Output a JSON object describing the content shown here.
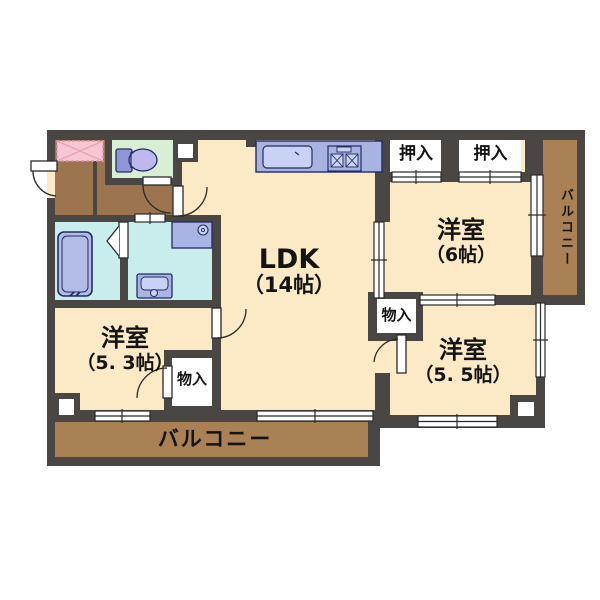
{
  "rooms": {
    "ldk": {
      "name": "LDK",
      "size": "（14帖）"
    },
    "bedroom_ne": {
      "name": "洋室",
      "size": "（6帖）"
    },
    "bedroom_se": {
      "name": "洋室",
      "size": "（5. 5帖）"
    },
    "bedroom_sw": {
      "name": "洋室",
      "size": "（5. 3帖）"
    }
  },
  "closets": {
    "oshiire_left": "押入",
    "oshiire_right": "押入",
    "monoiri_sw": "物入",
    "monoiri_se": "物入"
  },
  "balconies": {
    "south": "バルコニー",
    "east": "バルコニー"
  },
  "fixtures": {
    "bathtub": "bathtub-icon",
    "toilet": "toilet-icon",
    "washbasin": "washbasin-icon",
    "washing_machine_pan": "washing-machine-pan-icon",
    "kitchen_counter": "kitchen-counter-icon",
    "kitchen_sink": "kitchen-sink-icon",
    "stove": "stove-icon",
    "entrance_mat": "entrance-mat-icon"
  },
  "colors": {
    "wall": "#4a4643",
    "room_floor": "#fce9c5",
    "hall_floor": "#9c7450",
    "balcony_floor": "#aa8055",
    "wet_area_floor": "#c9ecec",
    "toilet_floor": "#d9efd5",
    "fixture_fill": "#b2bae6",
    "fixture_light": "#c9d2f5",
    "mat_pink": "#f7c6d2",
    "counter_blue": "#a9b3e2",
    "outline_navy": "#232b63"
  }
}
